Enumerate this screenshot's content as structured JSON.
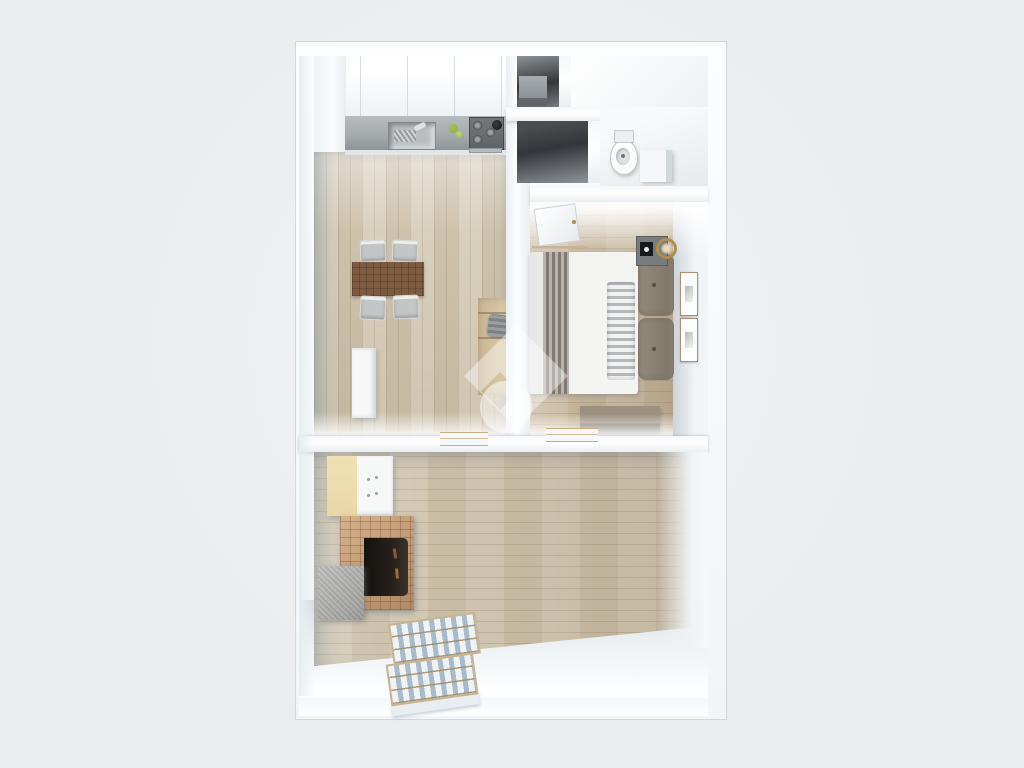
{
  "meta": {
    "image_type": "3d-floorplan-render",
    "description": "Top-down 3D render of a one-bedroom apartment: kitchen-dining room with counter, sink, stove, dining table and desk; two dark storage niches; bathroom with toilet and cabinet; bedroom with double bed, nightstand, bench and wall pictures; lower living room with cream cabinet, brick fireplace, concrete block and slatted staircase; semi-transparent diamond-and-circle watermark in the center.",
    "visible_text": ""
  },
  "rooms": [
    {
      "id": "kitchen-dining",
      "position": "top-left"
    },
    {
      "id": "storage-niche-upper",
      "position": "top-middle"
    },
    {
      "id": "storage-niche-lower",
      "position": "top-middle"
    },
    {
      "id": "bathroom",
      "position": "top-right"
    },
    {
      "id": "bedroom",
      "position": "middle-right"
    },
    {
      "id": "living-room",
      "position": "bottom"
    }
  ],
  "objects": [
    "upper-cabinets",
    "kitchen-counter",
    "sink",
    "stove",
    "green-fruit",
    "dining-table",
    "dining-chairs",
    "desk",
    "desk-chair",
    "white-cabinet",
    "niche-cabinet",
    "toilet",
    "bath-cabinet",
    "bedroom-door",
    "double-bed",
    "bed-runner",
    "ribbed-throw",
    "pillows",
    "nightstand",
    "speaker",
    "gold-lamp",
    "bench",
    "picture-frames",
    "cream-cabinet",
    "brick-fireplace",
    "concrete-block",
    "slatted-staircase",
    "door-thresholds",
    "watermark-logo"
  ],
  "watermark": {
    "shape": "rotated-square-with-notch-plus-circle",
    "color": "#ffffff",
    "opacity": 0.45
  },
  "palette": {
    "bg": "#eaecee",
    "bg2": "#f1f2f4",
    "wall": "#f5f8fa",
    "wallEdge": "rgba(185,196,206,0.55)",
    "nicheDark": "#35383b",
    "kitchenFloor": "#d4cab5",
    "bedroomFloor": "#c7b69c",
    "livingFloor": "#cec2ab",
    "plankLine": "rgba(125,105,75,0.22)",
    "bathFloorA": "#ffffff",
    "bathFloorB": "#dfe3e6",
    "counterTop": "#a4a9ab",
    "counterFront": "#e2e6e8",
    "sinkSteel": "#b9bec1",
    "stoveBody": "#5f6366",
    "greenA": "#8fae3e",
    "greenB": "#a9c24e",
    "tableWood": "#7c5b40",
    "chairFrame": "#d8d9d7",
    "chairSeat": "#c3c6c7",
    "deskWood": "#d6c5a5",
    "whiteCabinet": "#f5f7f8",
    "creamCabinet": "#ead7a6",
    "cabinetWhite": "#f6f7f7",
    "brick": "#c39a73",
    "brickLine": "rgba(90,58,36,0.28)",
    "fireOpening": "#241f1a",
    "concrete": "#a9a9a7",
    "duvet": "#f4f4f3",
    "runner": "#99918a",
    "throwLight": "#f2f2f1",
    "throwDark": "#b4b8ba",
    "pillow": "#958b7d",
    "pillowDark": "#7e7466",
    "nightstand": "#797c7f",
    "speaker": "#17181a",
    "lampGold": "#b08d4f",
    "bench": "#9d9081",
    "benchFront": "#73685a",
    "frameWood": "#a98f78",
    "doorFrame": "#c8b394",
    "thresholdTan": "#c8ab7e",
    "stairSlatLight": "#eff3f6",
    "stairSlatDark": "#a9bac9",
    "stairFrame": "#c7b493",
    "stairBase": "#e8edf1",
    "watermark": "#ffffff"
  }
}
